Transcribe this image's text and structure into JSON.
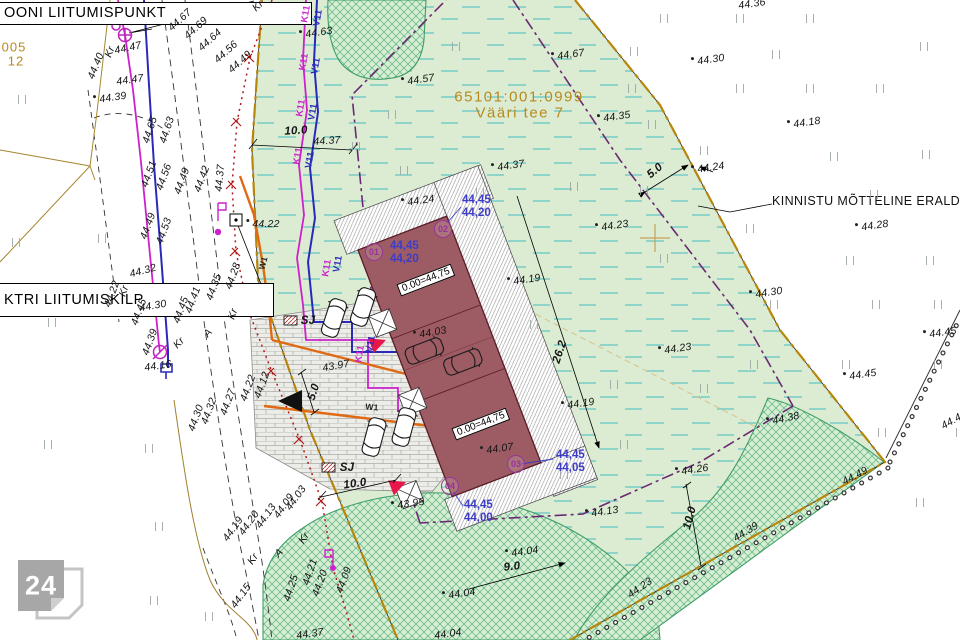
{
  "parcel": {
    "cadastral": "65101:001:0999",
    "address": "Vääri tee 7"
  },
  "callouts": {
    "liitumispunkt": "OONI LIITUMISPUNKT",
    "liitumiskilp": "KTRI LIITUMISKILP",
    "eraldusjoon": "KINNISTU MÕTTELINE ERALDUSJOO",
    "ref1": "005",
    "ref2": "12"
  },
  "logo": {
    "text": "24"
  },
  "buildings": {
    "floor_labels": [
      {
        "text": "0.00=44,75",
        "x": 426,
        "y": 280,
        "r": -21
      },
      {
        "text": "0.00=44,75",
        "x": 481,
        "y": 424,
        "r": -21
      }
    ],
    "corner_markers": [
      {
        "id": "01",
        "cx": 374,
        "cy": 252,
        "tx": 390,
        "ty": 246,
        "lines": [
          "44,45",
          "44,20"
        ]
      },
      {
        "id": "02",
        "cx": 443,
        "cy": 229,
        "tx": 462,
        "ty": 200,
        "lines": [
          "44,45",
          "44,20"
        ]
      },
      {
        "id": "03",
        "cx": 516,
        "cy": 464,
        "tx": 556,
        "ty": 455,
        "lines": [
          "44,45",
          "44,05"
        ]
      },
      {
        "id": "04",
        "cx": 450,
        "cy": 486,
        "tx": 464,
        "ty": 505,
        "lines": [
          "44,45",
          "44,00"
        ]
      }
    ]
  },
  "colors": {
    "plot_green": "#dcecd2",
    "building_maroon": "#9d5c64",
    "boundary_olive": "#b8860b",
    "envelope_purple": "#6a2a72",
    "sewer_magenta": "#cc22cc",
    "water_blue": "#2a2ab8",
    "heat_orange": "#e06a14",
    "electric_red": "#b01818",
    "title_olive": "#b8891f",
    "corner_blue": "#3c3cc8",
    "marker_purple": "#993399",
    "entrance_red": "#e8174b"
  },
  "labels": [
    {
      "t": "44.47",
      "x": 128,
      "y": 48,
      "r": -12
    },
    {
      "t": "Kr",
      "x": 110,
      "y": 52,
      "r": -68
    },
    {
      "t": "44.40",
      "x": 96,
      "y": 66,
      "r": -68
    },
    {
      "t": "44.47",
      "x": 130,
      "y": 80,
      "r": -8
    },
    {
      "t": "44.39",
      "x": 110,
      "y": 98,
      "r": -8,
      "pt": 1
    },
    {
      "t": "44.65",
      "x": 150,
      "y": 130,
      "r": -72
    },
    {
      "t": "44.63",
      "x": 167,
      "y": 130,
      "r": -72
    },
    {
      "t": "44.67",
      "x": 180,
      "y": 20,
      "r": -42
    },
    {
      "t": "44.69",
      "x": 196,
      "y": 28,
      "r": -42
    },
    {
      "t": "44.64",
      "x": 210,
      "y": 40,
      "r": -42
    },
    {
      "t": "44.56",
      "x": 226,
      "y": 52,
      "r": -42
    },
    {
      "t": "44.49",
      "x": 240,
      "y": 62,
      "r": -42
    },
    {
      "t": "Kr",
      "x": 258,
      "y": 6,
      "r": -42
    },
    {
      "t": "44.51",
      "x": 149,
      "y": 174,
      "r": -70
    },
    {
      "t": "44.56",
      "x": 164,
      "y": 177,
      "r": -70
    },
    {
      "t": "44.49",
      "x": 182,
      "y": 181,
      "r": -70
    },
    {
      "t": "44.42",
      "x": 202,
      "y": 179,
      "r": -70
    },
    {
      "t": "44.37",
      "x": 220,
      "y": 178,
      "r": -85
    },
    {
      "t": "44.49",
      "x": 148,
      "y": 226,
      "r": -70
    },
    {
      "t": "44.53",
      "x": 164,
      "y": 231,
      "r": -70
    },
    {
      "t": "44.32",
      "x": 143,
      "y": 271,
      "r": -15
    },
    {
      "t": "44.22",
      "x": 112,
      "y": 294,
      "r": -70
    },
    {
      "t": "Kr",
      "x": 124,
      "y": 291,
      "r": -70
    },
    {
      "t": "44.30",
      "x": 153,
      "y": 306,
      "r": -10
    },
    {
      "t": "44.45",
      "x": 139,
      "y": 312,
      "r": -70
    },
    {
      "t": "44.45",
      "x": 181,
      "y": 310,
      "r": -70
    },
    {
      "t": "44.41",
      "x": 193,
      "y": 300,
      "r": -70
    },
    {
      "t": "44.35",
      "x": 214,
      "y": 287,
      "r": -70
    },
    {
      "t": "44.28",
      "x": 233,
      "y": 276,
      "r": -70
    },
    {
      "t": "Kr",
      "x": 233,
      "y": 314,
      "r": -70
    },
    {
      "t": "44.22",
      "x": 263,
      "y": 224,
      "r": 0,
      "pt": 1
    },
    {
      "t": "44.16",
      "x": 158,
      "y": 366,
      "r": -8
    },
    {
      "t": "44.39",
      "x": 150,
      "y": 342,
      "r": -70
    },
    {
      "t": "Kr",
      "x": 179,
      "y": 343,
      "r": -45
    },
    {
      "t": "A",
      "x": 208,
      "y": 333,
      "r": -50
    },
    {
      "t": "44.12",
      "x": 262,
      "y": 385,
      "r": -70
    },
    {
      "t": "44.22",
      "x": 248,
      "y": 388,
      "r": -70
    },
    {
      "t": "44.27",
      "x": 228,
      "y": 402,
      "r": -70
    },
    {
      "t": "44.32",
      "x": 209,
      "y": 411,
      "r": -70
    },
    {
      "t": "44.30",
      "x": 196,
      "y": 418,
      "r": -70
    },
    {
      "t": "44.03",
      "x": 296,
      "y": 498,
      "r": -55
    },
    {
      "t": "44.09",
      "x": 284,
      "y": 506,
      "r": -55
    },
    {
      "t": "Kr",
      "x": 304,
      "y": 538,
      "r": -55
    },
    {
      "t": "44.13",
      "x": 266,
      "y": 516,
      "r": -55
    },
    {
      "t": "44.20",
      "x": 249,
      "y": 523,
      "r": -55
    },
    {
      "t": "44.19",
      "x": 233,
      "y": 529,
      "r": -55
    },
    {
      "t": "A",
      "x": 279,
      "y": 553,
      "r": -45
    },
    {
      "t": "44.25",
      "x": 291,
      "y": 588,
      "r": -72
    },
    {
      "t": "44.21",
      "x": 310,
      "y": 572,
      "r": -72
    },
    {
      "t": "Kr",
      "x": 253,
      "y": 559,
      "r": -55
    },
    {
      "t": "44.15",
      "x": 241,
      "y": 596,
      "r": -55
    },
    {
      "t": "44.20",
      "x": 320,
      "y": 583,
      "r": -70
    },
    {
      "t": "44.09",
      "x": 344,
      "y": 580,
      "r": -70
    },
    {
      "t": "44.37",
      "x": 310,
      "y": 634,
      "r": -8
    },
    {
      "t": "44.63",
      "x": 316,
      "y": 33,
      "r": -8,
      "pt": 1
    },
    {
      "t": "44.67",
      "x": 568,
      "y": 55,
      "r": -8,
      "pt": 1
    },
    {
      "t": "44.57",
      "x": 418,
      "y": 80,
      "r": -8,
      "pt": 1
    },
    {
      "t": "44.35",
      "x": 614,
      "y": 117,
      "r": -8,
      "pt": 1
    },
    {
      "t": "44.37",
      "x": 508,
      "y": 166,
      "r": -8,
      "pt": 1
    },
    {
      "t": "44.37",
      "x": 327,
      "y": 141,
      "r": -4
    },
    {
      "t": "44.24",
      "x": 418,
      "y": 201,
      "r": -8,
      "pt": 1
    },
    {
      "t": "44.23",
      "x": 612,
      "y": 226,
      "r": -8,
      "pt": 1
    },
    {
      "t": "44.19",
      "x": 524,
      "y": 280,
      "r": -8,
      "pt": 1
    },
    {
      "t": "44.23",
      "x": 675,
      "y": 349,
      "r": -8,
      "pt": 1
    },
    {
      "t": "44.19",
      "x": 578,
      "y": 404,
      "r": -8,
      "pt": 1
    },
    {
      "t": "43.97",
      "x": 336,
      "y": 366,
      "r": -10
    },
    {
      "t": "43.95",
      "x": 408,
      "y": 504,
      "r": -8,
      "pt": 1
    },
    {
      "t": "44.03",
      "x": 430,
      "y": 333,
      "r": -10,
      "pt": 1
    },
    {
      "t": "44.07",
      "x": 497,
      "y": 449,
      "r": -8,
      "pt": 1
    },
    {
      "t": "44.04",
      "x": 522,
      "y": 552,
      "r": -8,
      "pt": 1
    },
    {
      "t": "44.04",
      "x": 459,
      "y": 594,
      "r": -8,
      "pt": 1
    },
    {
      "t": "44.04",
      "x": 448,
      "y": 634,
      "r": -8
    },
    {
      "t": "44.13",
      "x": 602,
      "y": 512,
      "r": -8,
      "pt": 1
    },
    {
      "t": "44.36",
      "x": 752,
      "y": 4,
      "r": -8
    },
    {
      "t": "44.30",
      "x": 708,
      "y": 60,
      "r": -8,
      "pt": 1
    },
    {
      "t": "44.18",
      "x": 804,
      "y": 123,
      "r": -8,
      "pt": 1
    },
    {
      "t": "44.24",
      "x": 708,
      "y": 168,
      "r": -8,
      "pt": 1
    },
    {
      "t": "44.28",
      "x": 872,
      "y": 226,
      "r": -8,
      "pt": 1
    },
    {
      "t": "44.30",
      "x": 766,
      "y": 293,
      "r": -8,
      "pt": 1
    },
    {
      "t": "44.45",
      "x": 860,
      "y": 375,
      "r": -8,
      "pt": 1
    },
    {
      "t": "44.45",
      "x": 940,
      "y": 333,
      "r": -8,
      "pt": 1
    },
    {
      "t": "44.38",
      "x": 783,
      "y": 419,
      "r": -12,
      "pt": 1
    },
    {
      "t": "44.26",
      "x": 692,
      "y": 470,
      "r": -8,
      "pt": 1
    },
    {
      "t": "44.49",
      "x": 855,
      "y": 476,
      "r": -28
    },
    {
      "t": "44.45",
      "x": 954,
      "y": 420,
      "r": -30
    },
    {
      "t": "44.39",
      "x": 746,
      "y": 532,
      "r": -32
    },
    {
      "t": "44.23",
      "x": 640,
      "y": 588,
      "r": -35
    },
    {
      "t": "10.0",
      "x": 296,
      "y": 131,
      "r": -4,
      "c": "dim"
    },
    {
      "t": "5.0",
      "x": 655,
      "y": 171,
      "r": -40,
      "c": "dim"
    },
    {
      "t": "26.2",
      "x": 560,
      "y": 352,
      "r": -72,
      "c": "dim"
    },
    {
      "t": "9.0",
      "x": 512,
      "y": 567,
      "r": -6,
      "c": "dim"
    },
    {
      "t": "10.0",
      "x": 690,
      "y": 518,
      "r": -75,
      "c": "dim"
    },
    {
      "t": "5.0",
      "x": 314,
      "y": 392,
      "r": -72,
      "c": "dim"
    },
    {
      "t": "10.0",
      "x": 355,
      "y": 484,
      "r": -8,
      "c": "dim"
    },
    {
      "t": "K11",
      "x": 306,
      "y": 14,
      "r": -80,
      "c": "uk"
    },
    {
      "t": "V11",
      "x": 318,
      "y": 18,
      "r": -80,
      "c": "uv"
    },
    {
      "t": "K11",
      "x": 304,
      "y": 62,
      "r": -80,
      "c": "uk"
    },
    {
      "t": "V11",
      "x": 316,
      "y": 66,
      "r": -80,
      "c": "uv"
    },
    {
      "t": "K11",
      "x": 301,
      "y": 108,
      "r": -80,
      "c": "uk"
    },
    {
      "t": "V11",
      "x": 313,
      "y": 112,
      "r": -80,
      "c": "uv"
    },
    {
      "t": "K11",
      "x": 298,
      "y": 156,
      "r": -80,
      "c": "uk"
    },
    {
      "t": "V11",
      "x": 310,
      "y": 160,
      "r": -80,
      "c": "uv"
    },
    {
      "t": "K11",
      "x": 327,
      "y": 268,
      "r": -80,
      "c": "uk"
    },
    {
      "t": "V11",
      "x": 338,
      "y": 264,
      "r": -80,
      "c": "uv"
    },
    {
      "t": "K11",
      "x": 360,
      "y": 354,
      "r": -80,
      "c": "uk"
    },
    {
      "t": "V11",
      "x": 371,
      "y": 344,
      "r": -80,
      "c": "uv"
    },
    {
      "t": "W1",
      "x": 263,
      "y": 263,
      "r": -75,
      "c": "w1"
    },
    {
      "t": "W1",
      "x": 372,
      "y": 407,
      "r": 5,
      "c": "w1"
    },
    {
      "t": "SJ",
      "x": 308,
      "y": 321,
      "r": 0,
      "c": "sj"
    },
    {
      "t": "SJ",
      "x": 347,
      "y": 468,
      "r": 0,
      "c": "sj"
    }
  ],
  "grass_marks": [
    [
      660,
      14
    ],
    [
      736,
      14
    ],
    [
      806,
      14
    ],
    [
      630,
      47
    ],
    [
      772,
      50
    ],
    [
      920,
      42
    ],
    [
      628,
      84
    ],
    [
      736,
      84
    ],
    [
      806,
      84
    ],
    [
      876,
      84
    ],
    [
      648,
      120
    ],
    [
      700,
      146
    ],
    [
      922,
      150
    ],
    [
      830,
      152
    ],
    [
      640,
      186
    ],
    [
      870,
      190
    ],
    [
      846,
      256
    ],
    [
      926,
      256
    ],
    [
      660,
      254
    ],
    [
      872,
      300
    ],
    [
      934,
      300
    ],
    [
      750,
      360
    ],
    [
      842,
      360
    ],
    [
      934,
      360
    ],
    [
      878,
      428
    ],
    [
      956,
      428
    ],
    [
      916,
      498
    ],
    [
      18,
      95
    ],
    [
      12,
      238
    ],
    [
      48,
      318
    ],
    [
      98,
      234
    ],
    [
      145,
      444
    ],
    [
      44,
      440
    ],
    [
      155,
      522
    ],
    [
      205,
      612
    ],
    [
      150,
      596
    ],
    [
      352,
      142
    ],
    [
      452,
      42
    ],
    [
      400,
      166
    ],
    [
      476,
      188
    ],
    [
      570,
      182
    ],
    [
      530,
      320
    ],
    [
      610,
      380
    ],
    [
      620,
      440
    ],
    [
      700,
      384
    ],
    [
      770,
      300
    ],
    [
      746,
      224
    ],
    [
      560,
      470
    ],
    [
      388,
      110
    ]
  ]
}
